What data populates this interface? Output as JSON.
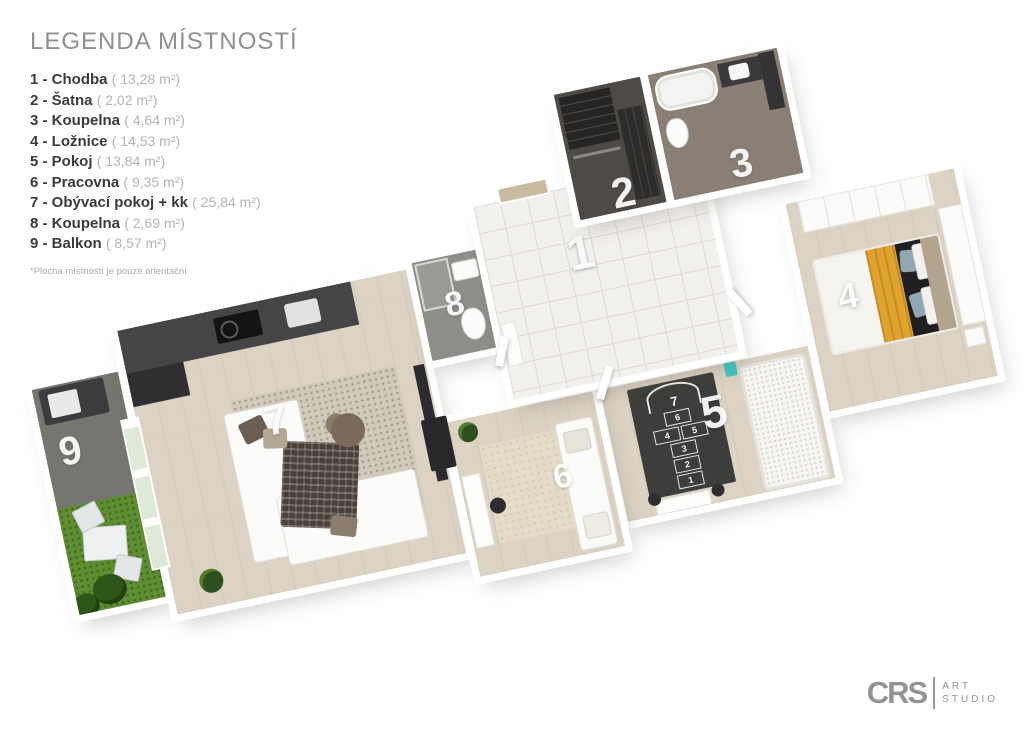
{
  "legend": {
    "title": "LEGENDA MÍSTNOSTÍ",
    "items": [
      {
        "label": "1 - Chodba",
        "area": "( 13,28 m²)"
      },
      {
        "label": "2 - Šatna",
        "area": "( 2,02 m²)"
      },
      {
        "label": "3 - Koupelna",
        "area": "( 4,64 m²)"
      },
      {
        "label": "4 - Ložnice",
        "area": "( 14,53 m²)"
      },
      {
        "label": "5 - Pokoj",
        "area": "( 13,84 m²)"
      },
      {
        "label": "6 - Pracovna",
        "area": "( 9,35 m²)"
      },
      {
        "label": "7 - Obývací pokoj + kk",
        "area": "( 25,84 m²)"
      },
      {
        "label": "8 - Koupelna",
        "area": "( 2,69 m²)"
      },
      {
        "label": "9 - Balkon",
        "area": "( 8,57 m²)"
      }
    ],
    "footnote": "*Plocha místností je pouze orientační"
  },
  "plan": {
    "rooms": {
      "r1": "1",
      "r2": "2",
      "r3": "3",
      "r4": "4",
      "r5": "5",
      "r6": "6",
      "r7": "7",
      "r8": "8",
      "r9": "9"
    },
    "hopscotch": [
      "7",
      "6",
      "4",
      "5",
      "3",
      "2",
      "1"
    ]
  },
  "logo": {
    "monogram": "CRS",
    "top": "ART",
    "bottom": "STUDIO"
  },
  "colors": {
    "wood_floor": "#dcd3c5",
    "tile_floor": "#f3f1ee",
    "bath_floor": "#8a7f74",
    "balcony_floor": "#77756f",
    "grass": "#5f8d32",
    "hopscotch_rug": "#3b3e3a",
    "bed_blanket_yellow": "#dfa32e",
    "legend_text": "#3b3b3b",
    "legend_muted": "#b6b3b0"
  }
}
